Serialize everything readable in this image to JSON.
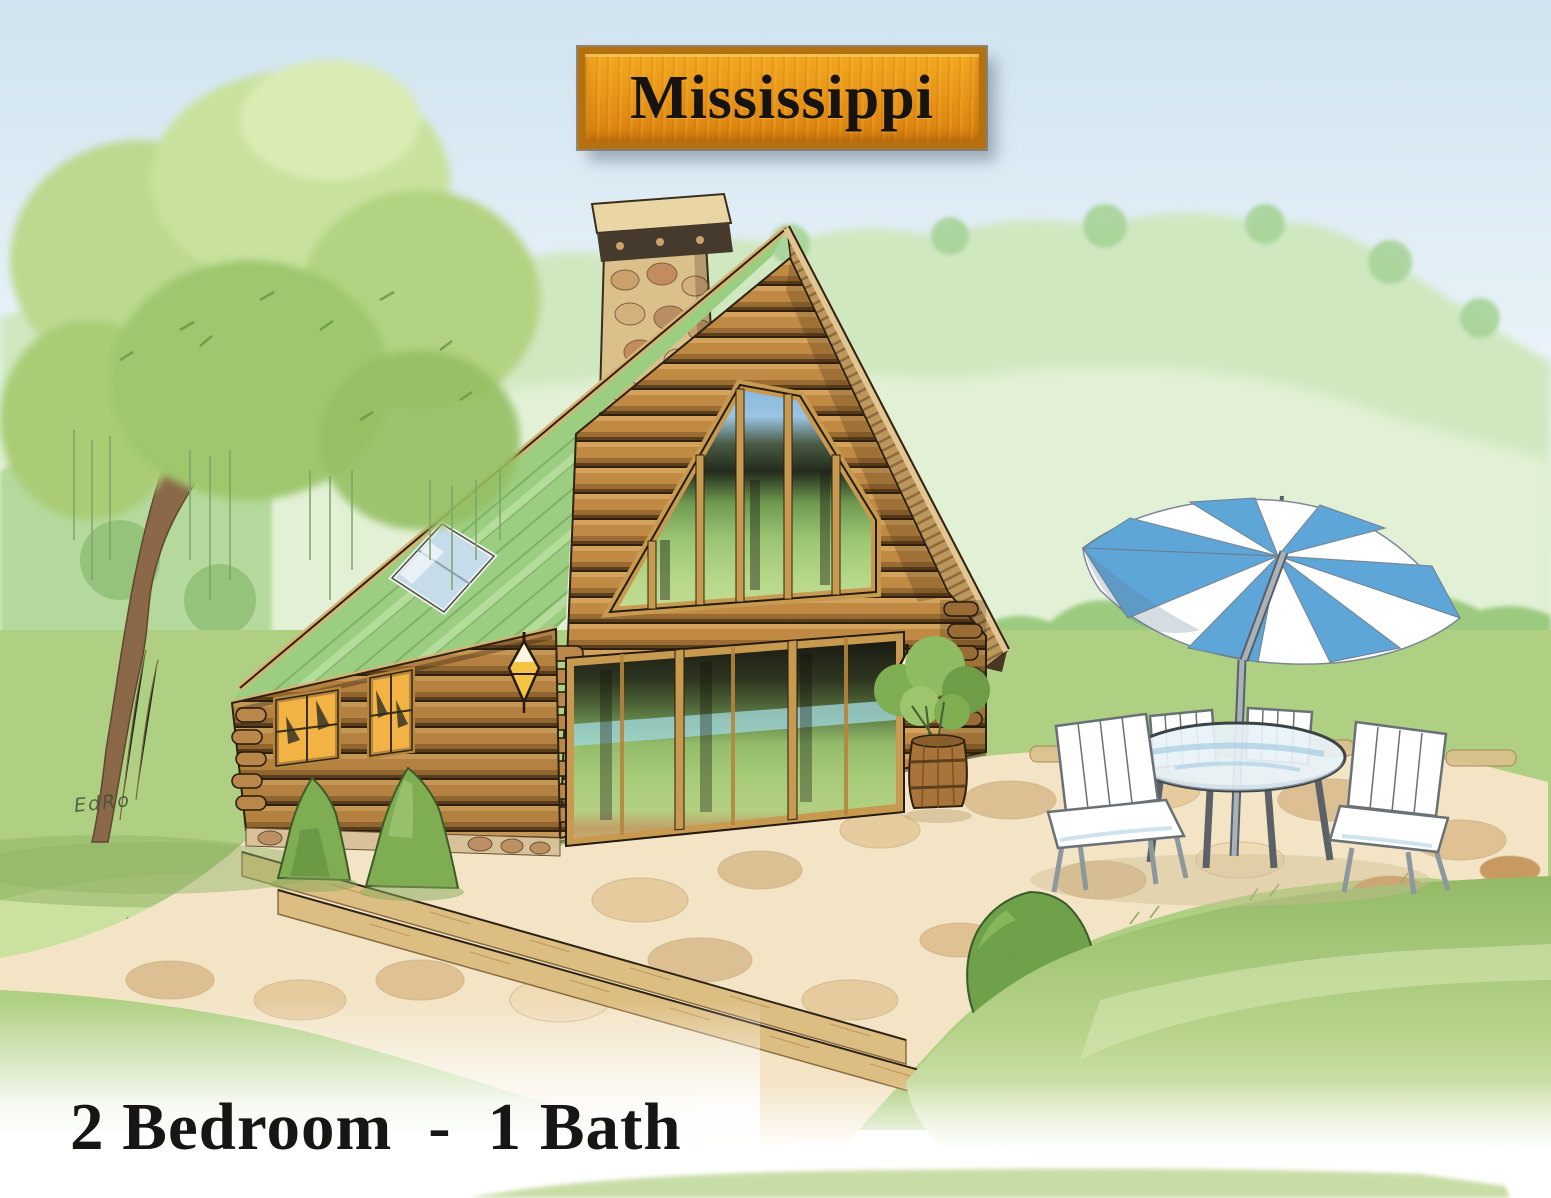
{
  "page": {
    "title": "Mississippi",
    "caption": {
      "bedrooms": "2 Bedroom",
      "separator": "-",
      "baths": "1 Bath"
    },
    "signature": "EdRo"
  },
  "colors": {
    "plate_orange": "#E79417",
    "plate_border": "#B5710F",
    "text_ink": "#171614",
    "roof_green": "#9CCE82",
    "log_tan": "#C08A45",
    "window_glow": "#F2B344",
    "glass_green": "#93BB6A",
    "umbrella_blue": "#5FA6D8",
    "sky_blue": "#CFE3F0",
    "grass_green": "#AFD083",
    "patio_cream": "#F2E4C4",
    "foliage_green": "#A7D398"
  }
}
